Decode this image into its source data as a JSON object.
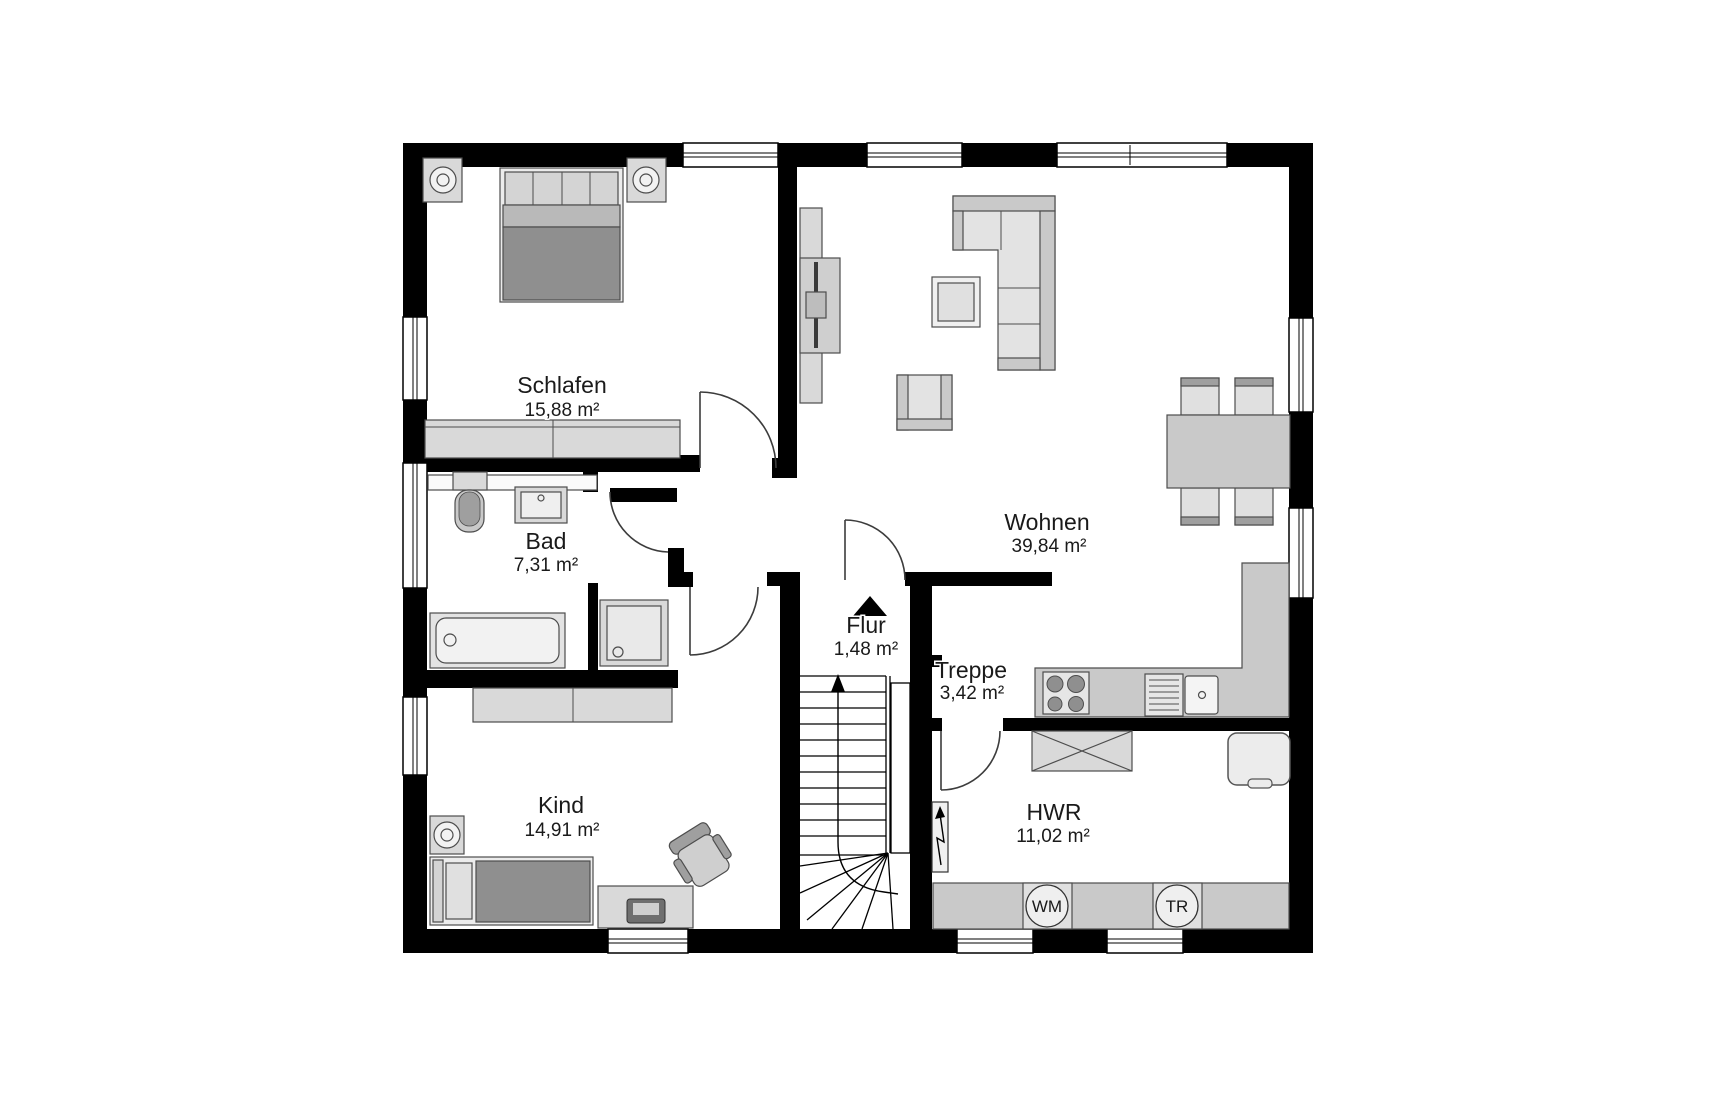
{
  "rooms": [
    {
      "id": "schlafen",
      "name": "Schlafen",
      "area": "15,88 m²"
    },
    {
      "id": "bad",
      "name": "Bad",
      "area": "7,31 m²"
    },
    {
      "id": "kind",
      "name": "Kind",
      "area": "14,91 m²"
    },
    {
      "id": "wohnen",
      "name": "Wohnen",
      "area": "39,84 m²"
    },
    {
      "id": "flur",
      "name": "Flur",
      "area": "1,48 m²"
    },
    {
      "id": "treppe",
      "name": "Treppe",
      "area": "3,42 m²"
    },
    {
      "id": "hwr",
      "name": "HWR",
      "area": "11,02 m²"
    }
  ],
  "appliances": {
    "washing_machine": "WM",
    "dryer": "TR"
  },
  "colors": {
    "wall": "#000000",
    "furniture_light": "#e3e3e3",
    "furniture_mid": "#c9c9c9",
    "furniture_dark": "#8f8f8f",
    "background": "#ffffff",
    "text": "#1a1a1a"
  }
}
